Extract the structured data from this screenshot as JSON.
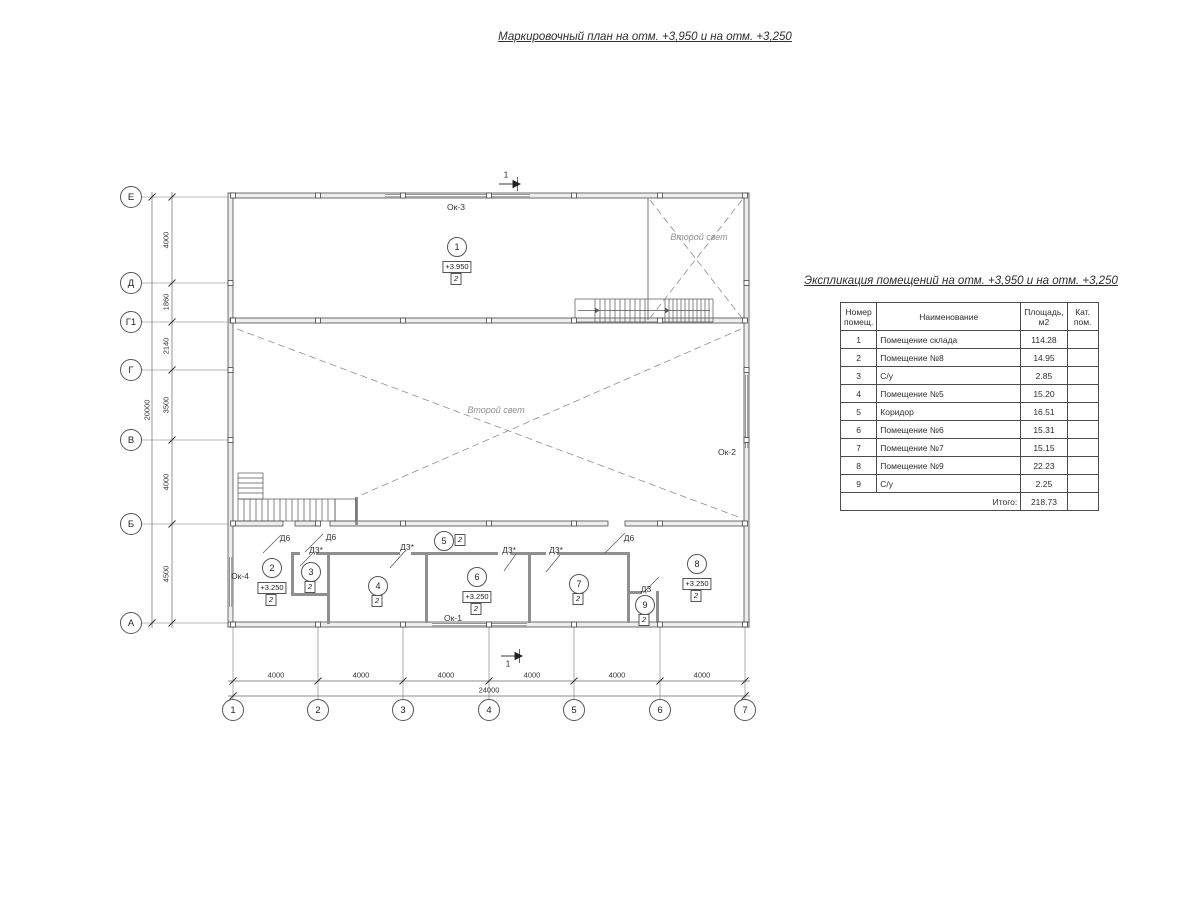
{
  "plan": {
    "title": "Маркировочный план на отм. +3,950 и на отм. +3,250",
    "axes_left": [
      {
        "label": "Е",
        "y": 197
      },
      {
        "label": "Д",
        "y": 283
      },
      {
        "label": "Г1",
        "y": 322
      },
      {
        "label": "Г",
        "y": 370
      },
      {
        "label": "В",
        "y": 440
      },
      {
        "label": "Б",
        "y": 524
      },
      {
        "label": "А",
        "y": 623
      }
    ],
    "axes_bottom": [
      {
        "label": "1",
        "x": 233
      },
      {
        "label": "2",
        "x": 318
      },
      {
        "label": "3",
        "x": 403
      },
      {
        "label": "4",
        "x": 489
      },
      {
        "label": "5",
        "x": 574
      },
      {
        "label": "6",
        "x": 660
      },
      {
        "label": "7",
        "x": 745
      }
    ],
    "dims_left": [
      {
        "text": "4000",
        "y": 240
      },
      {
        "text": "1860",
        "y": 302
      },
      {
        "text": "2140",
        "y": 346
      },
      {
        "text": "3500",
        "y": 405
      },
      {
        "text": "4000",
        "y": 482
      },
      {
        "text": "4500",
        "y": 574
      }
    ],
    "dim_left_total": {
      "text": "20000",
      "y": 410
    },
    "dims_bottom": [
      {
        "text": "4000",
        "x": 276
      },
      {
        "text": "4000",
        "x": 361
      },
      {
        "text": "4000",
        "x": 446
      },
      {
        "text": "4000",
        "x": 532
      },
      {
        "text": "4000",
        "x": 617
      },
      {
        "text": "4000",
        "x": 702
      }
    ],
    "dim_bottom_total": {
      "text": "24000",
      "x": 489
    },
    "rooms": [
      {
        "num": "1",
        "elev": "+3.950",
        "cat": "2",
        "x": 457,
        "y": 247
      },
      {
        "num": "2",
        "elev": "+3.250",
        "cat": "2",
        "x": 272,
        "y": 568
      },
      {
        "num": "3",
        "cat": "2",
        "x": 311,
        "y": 572
      },
      {
        "num": "4",
        "cat": "2",
        "x": 378,
        "y": 586
      },
      {
        "num": "5",
        "cat": "2",
        "x": 444,
        "y": 541,
        "cat_side": true
      },
      {
        "num": "6",
        "elev": "+3.250",
        "cat": "2",
        "x": 477,
        "y": 577
      },
      {
        "num": "7",
        "cat": "2",
        "x": 579,
        "y": 584
      },
      {
        "num": "8",
        "elev": "+3.250",
        "cat": "2",
        "x": 697,
        "y": 564
      },
      {
        "num": "9",
        "cat": "2",
        "x": 645,
        "y": 605
      }
    ],
    "labels": [
      {
        "text": "Ок-3",
        "x": 456,
        "y": 207,
        "name": "window-label-ok3",
        "cls": "lbl"
      },
      {
        "text": "Ок-2",
        "x": 727,
        "y": 452,
        "name": "window-label-ok2",
        "cls": "lbl"
      },
      {
        "text": "Ок-4",
        "x": 240,
        "y": 576,
        "name": "window-label-ok4",
        "cls": "lbl"
      },
      {
        "text": "Ок-1",
        "x": 453,
        "y": 618,
        "name": "window-label-ok1",
        "cls": "lbl"
      },
      {
        "text": "Д6",
        "x": 285,
        "y": 538,
        "name": "door-label-d6",
        "cls": "lbl"
      },
      {
        "text": "Д6",
        "x": 331,
        "y": 537,
        "name": "door-label-d6",
        "cls": "lbl"
      },
      {
        "text": "Д6",
        "x": 629,
        "y": 538,
        "name": "door-label-d6",
        "cls": "lbl"
      },
      {
        "text": "Д3*",
        "x": 316,
        "y": 550,
        "name": "door-label-d3star",
        "cls": "lbl"
      },
      {
        "text": "Д3*",
        "x": 407,
        "y": 547,
        "name": "door-label-d3star",
        "cls": "lbl"
      },
      {
        "text": "Д3*",
        "x": 509,
        "y": 550,
        "name": "door-label-d3star",
        "cls": "lbl"
      },
      {
        "text": "Д3*",
        "x": 556,
        "y": 550,
        "name": "door-label-d3star",
        "cls": "lbl"
      },
      {
        "text": "Д3",
        "x": 646,
        "y": 589,
        "name": "door-label-d3",
        "cls": "lbl"
      },
      {
        "text": "Второй свет",
        "x": 699,
        "y": 237,
        "name": "second-light-label",
        "cls": "script"
      },
      {
        "text": "Второй свет",
        "x": 496,
        "y": 410,
        "name": "second-light-label",
        "cls": "script"
      }
    ],
    "section_marks": [
      {
        "text": "1",
        "x": 506,
        "y": 175
      },
      {
        "text": "1",
        "x": 508,
        "y": 664
      }
    ]
  },
  "table": {
    "title": "Экспликация помещений на отм. +3,950 и на отм. +3,250",
    "headers": [
      "Номер\nпомещ.",
      "Наименование",
      "Площадь,\nм2",
      "Кат.\nпом."
    ],
    "rows": [
      [
        "1",
        "Помещение склада",
        "114.28",
        ""
      ],
      [
        "2",
        "Помещение №8",
        "14.95",
        ""
      ],
      [
        "3",
        "С/у",
        "2.85",
        ""
      ],
      [
        "4",
        "Помещение №5",
        "15.20",
        ""
      ],
      [
        "5",
        "Коридор",
        "16.51",
        ""
      ],
      [
        "6",
        "Помещение №6",
        "15.31",
        ""
      ],
      [
        "7",
        "Помещение №7",
        "15.15",
        ""
      ],
      [
        "8",
        "Помещение №9",
        "22.23",
        ""
      ],
      [
        "9",
        "С/у",
        "2.25",
        ""
      ]
    ],
    "total_label": "Итого:",
    "total_value": "218.73"
  }
}
